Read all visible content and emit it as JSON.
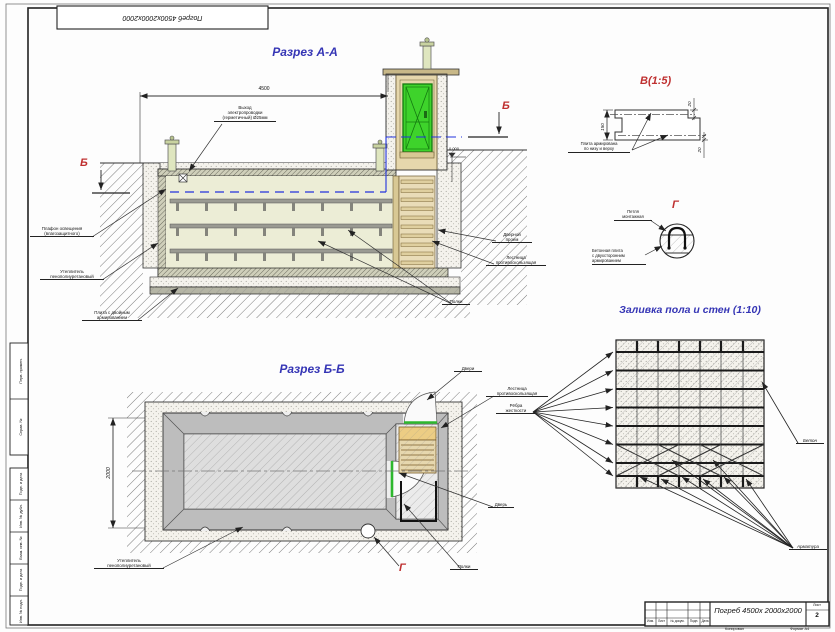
{
  "frame": {
    "corner_stamp": "Погреб 4500х2000х2000",
    "side_cells": [
      "Перв. примен.",
      "Справ. №",
      "Подп. и дата",
      "Инв. № дубл.",
      "Взам. инв. №",
      "Подп. и дата",
      "Инв. № подл."
    ],
    "notes": [
      "Копировал",
      "Формат А4"
    ]
  },
  "aa": {
    "title": "Разрез А-А",
    "dim_width": "4500",
    "elevation": "0.000",
    "marker": "Б",
    "wiring": [
      "Выход",
      "электропроводки",
      "(герметичный) Ø25мм"
    ],
    "lamp": [
      "Плафон освещения",
      "(влагозащитного)"
    ],
    "insulation": [
      "Утеплитель",
      "пенополиуретановый"
    ],
    "slab": [
      "Плита с двойным",
      "армированием"
    ],
    "doorway": [
      "Дверной",
      "проем"
    ],
    "ladder": [
      "Лестница",
      "противоскользящая"
    ],
    "shelves": "Полки"
  },
  "dv": {
    "title": "В(1:5)",
    "dim_h": "150",
    "dim_top": "20",
    "dim_bottom": "20",
    "label": [
      "Плита армирована",
      "по низу и верху"
    ]
  },
  "dg": {
    "title": "Г",
    "loop": [
      "Петля",
      "монтажная"
    ],
    "slab": [
      "Бетонная плита",
      "с двухсторонним",
      "армированием"
    ]
  },
  "pour": {
    "title": "Заливка пола и стен (1:10)",
    "concrete": "Бетон",
    "rebar": "Арматура"
  },
  "bb": {
    "title": "Разрез Б-Б",
    "dim_height": "2000",
    "marker_g": "Г",
    "doors": "Двери",
    "ladder": [
      "Лестница",
      "противоскользящая"
    ],
    "ribs": [
      "Рёбра",
      "жесткости"
    ],
    "door": "Дверь",
    "shelves": "Полки",
    "insulation": [
      "Утеплитель",
      "пенополиуретановый"
    ]
  },
  "tb": {
    "name": "Погреб 4500х 2000х2000",
    "cols": [
      "Изм.",
      "Лист",
      "№ докум.",
      "Подп.",
      "Дата"
    ],
    "sheet_label": "Лист",
    "sheet_number": "2"
  }
}
